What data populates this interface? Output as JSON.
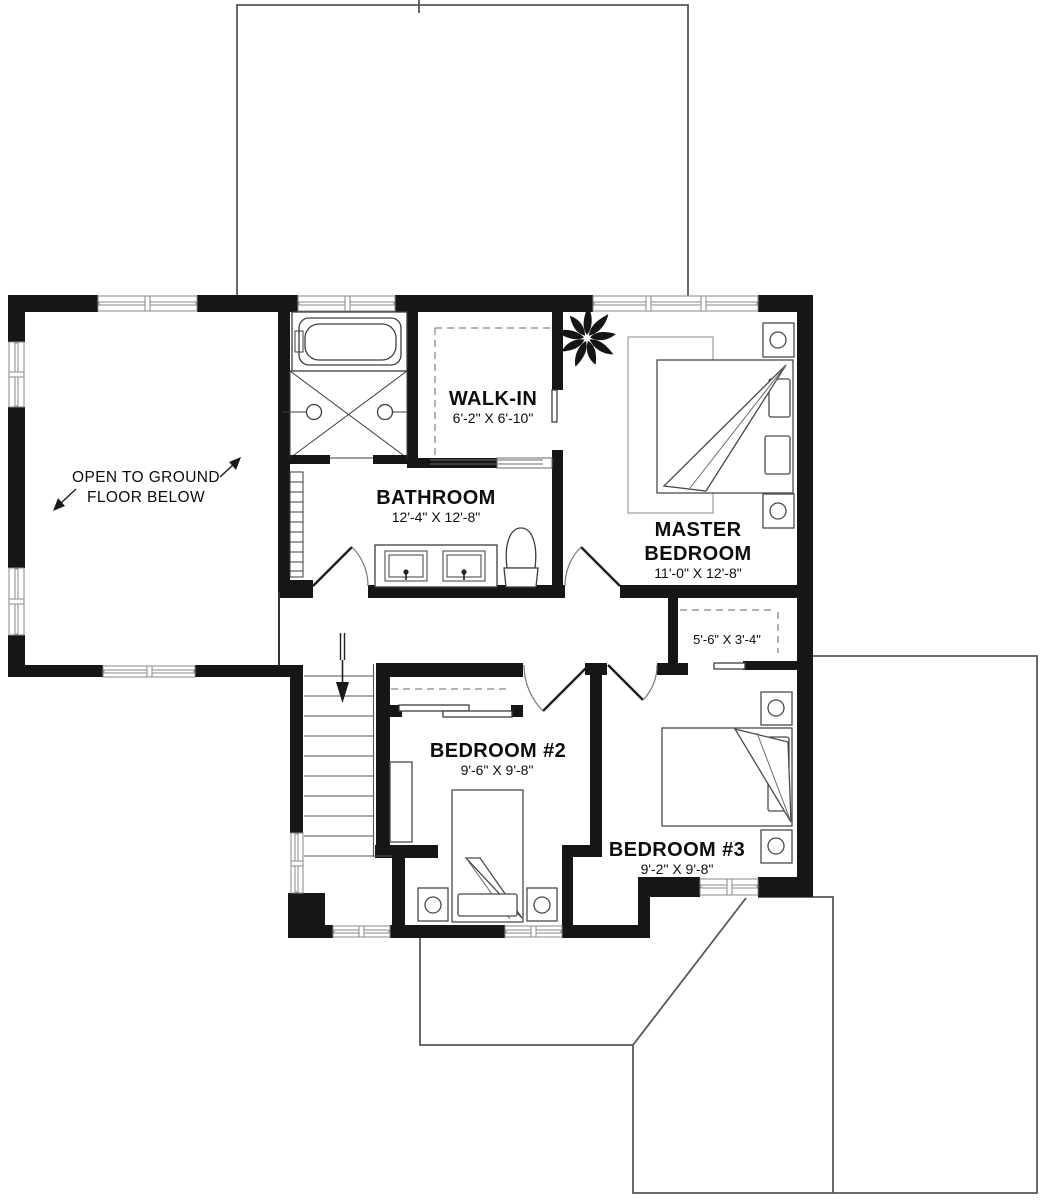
{
  "plan": {
    "open_area": {
      "line1": "OPEN TO GROUND",
      "line2": "FLOOR BELOW"
    },
    "rooms": {
      "walk_in": {
        "name": "WALK-IN",
        "dims": "6'-2\" X 6'-10\""
      },
      "bathroom": {
        "name": "BATHROOM",
        "dims": "12'-4\" X 12'-8\""
      },
      "master_bedroom": {
        "name_line1": "MASTER",
        "name_line2": "BEDROOM",
        "dims": "11'-0\" X 12'-8\""
      },
      "master_closet": {
        "dims": "5'-6\" X 3'-4\""
      },
      "bedroom_2": {
        "name": "BEDROOM #2",
        "dims": "9'-6\" X 9'-8\""
      },
      "bedroom_3": {
        "name": "BEDROOM #3",
        "dims": "9'-2\" X 9'-8\""
      }
    },
    "colors": {
      "wall_ink": "#161616",
      "roof_line": "#585858",
      "background": "#ffffff"
    }
  }
}
